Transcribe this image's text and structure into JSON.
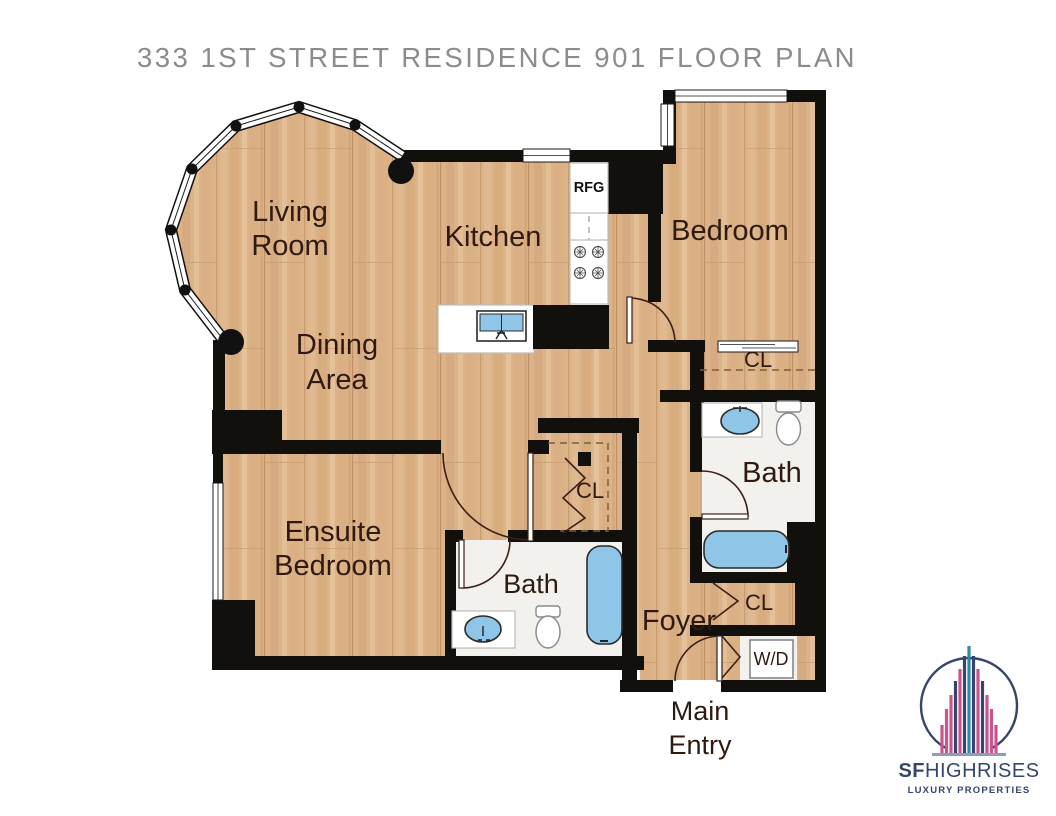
{
  "title": "333 1ST STREET RESIDENCE 901 FLOOR PLAN",
  "rooms": {
    "living_room": {
      "line1": "Living",
      "line2": "Room"
    },
    "kitchen": "Kitchen",
    "bedroom": "Bedroom",
    "dining": {
      "line1": "Dining",
      "line2": "Area"
    },
    "ensuite": {
      "line1": "Ensuite",
      "line2": "Bedroom"
    },
    "bath_main": "Bath",
    "bath_ensuite": "Bath",
    "foyer": "Foyer",
    "main_entry": {
      "line1": "Main",
      "line2": "Entry"
    }
  },
  "closets": {
    "bedroom_cl": "CL",
    "hall_cl": "CL",
    "foyer_cl": "CL"
  },
  "appliances": {
    "refrigerator": "RFG",
    "washer_dryer": "W/D"
  },
  "logo": {
    "brand_bold": "SF",
    "brand_light": "HIGHRISES",
    "tagline": "LUXURY PROPERTIES"
  },
  "colors": {
    "wood": "#dcb389",
    "wall": "#12100d",
    "bath_floor": "#f2f1ee",
    "fixture_blue": "#8fc6e8",
    "title_gray": "#8c8c8c",
    "label_brown": "#301a10",
    "logo_navy": "#35456b",
    "logo_pink": "#c9558e",
    "logo_teal": "#2e8aa8"
  }
}
